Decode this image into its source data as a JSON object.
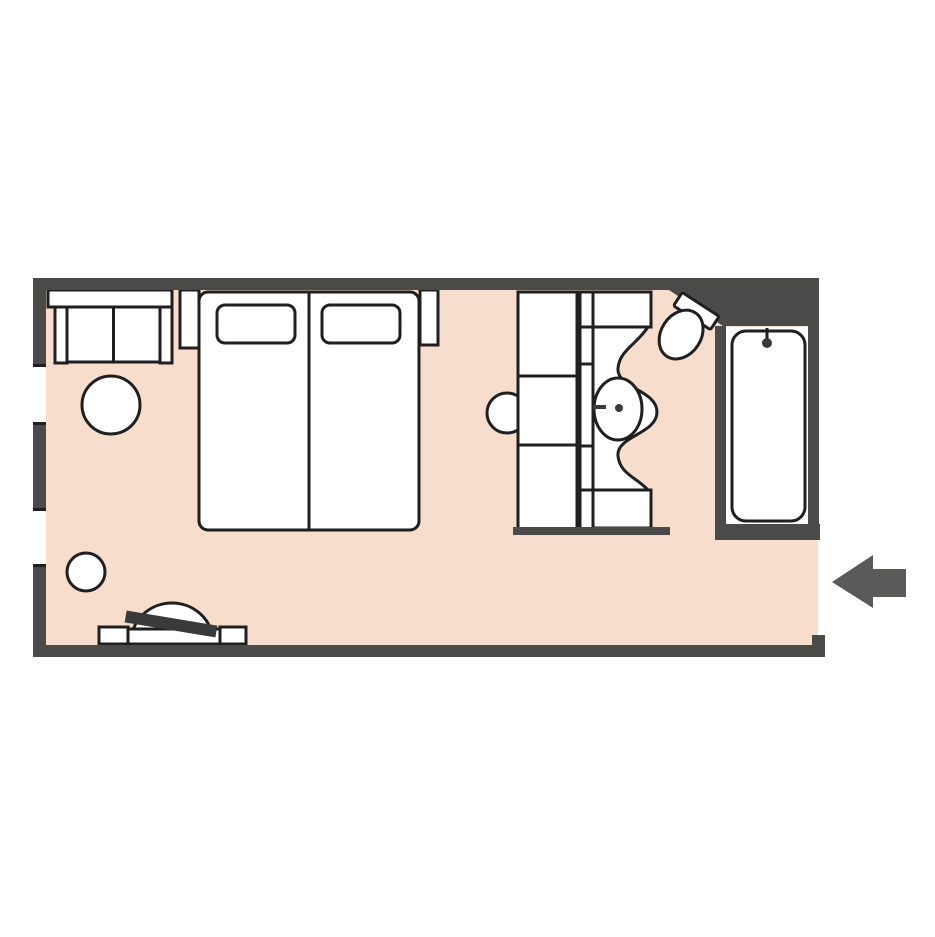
{
  "scene": {
    "type": "hotel-room-floor-plan",
    "entrance": {
      "side": "right",
      "indicator": "left-pointing-arrow"
    },
    "window_count": 2
  },
  "colors": {
    "bg": "#ffffff",
    "floor": "#f7ddcc",
    "wall": "#4a4a49",
    "outline": "#1f1f1f",
    "furniture": "#ffffff",
    "dark": "#3a3a3a",
    "arrow": "#5a5a58"
  },
  "furniture_icons": [
    "sofa-icon",
    "round-table-icon",
    "stool-icon",
    "nightstand-icon",
    "twin-beds-icon",
    "pillow-icon",
    "closet-icon",
    "vanity-sink-icon",
    "toilet-icon",
    "bathtub-icon",
    "luggage-bench-icon",
    "entrance-arrow-icon"
  ]
}
